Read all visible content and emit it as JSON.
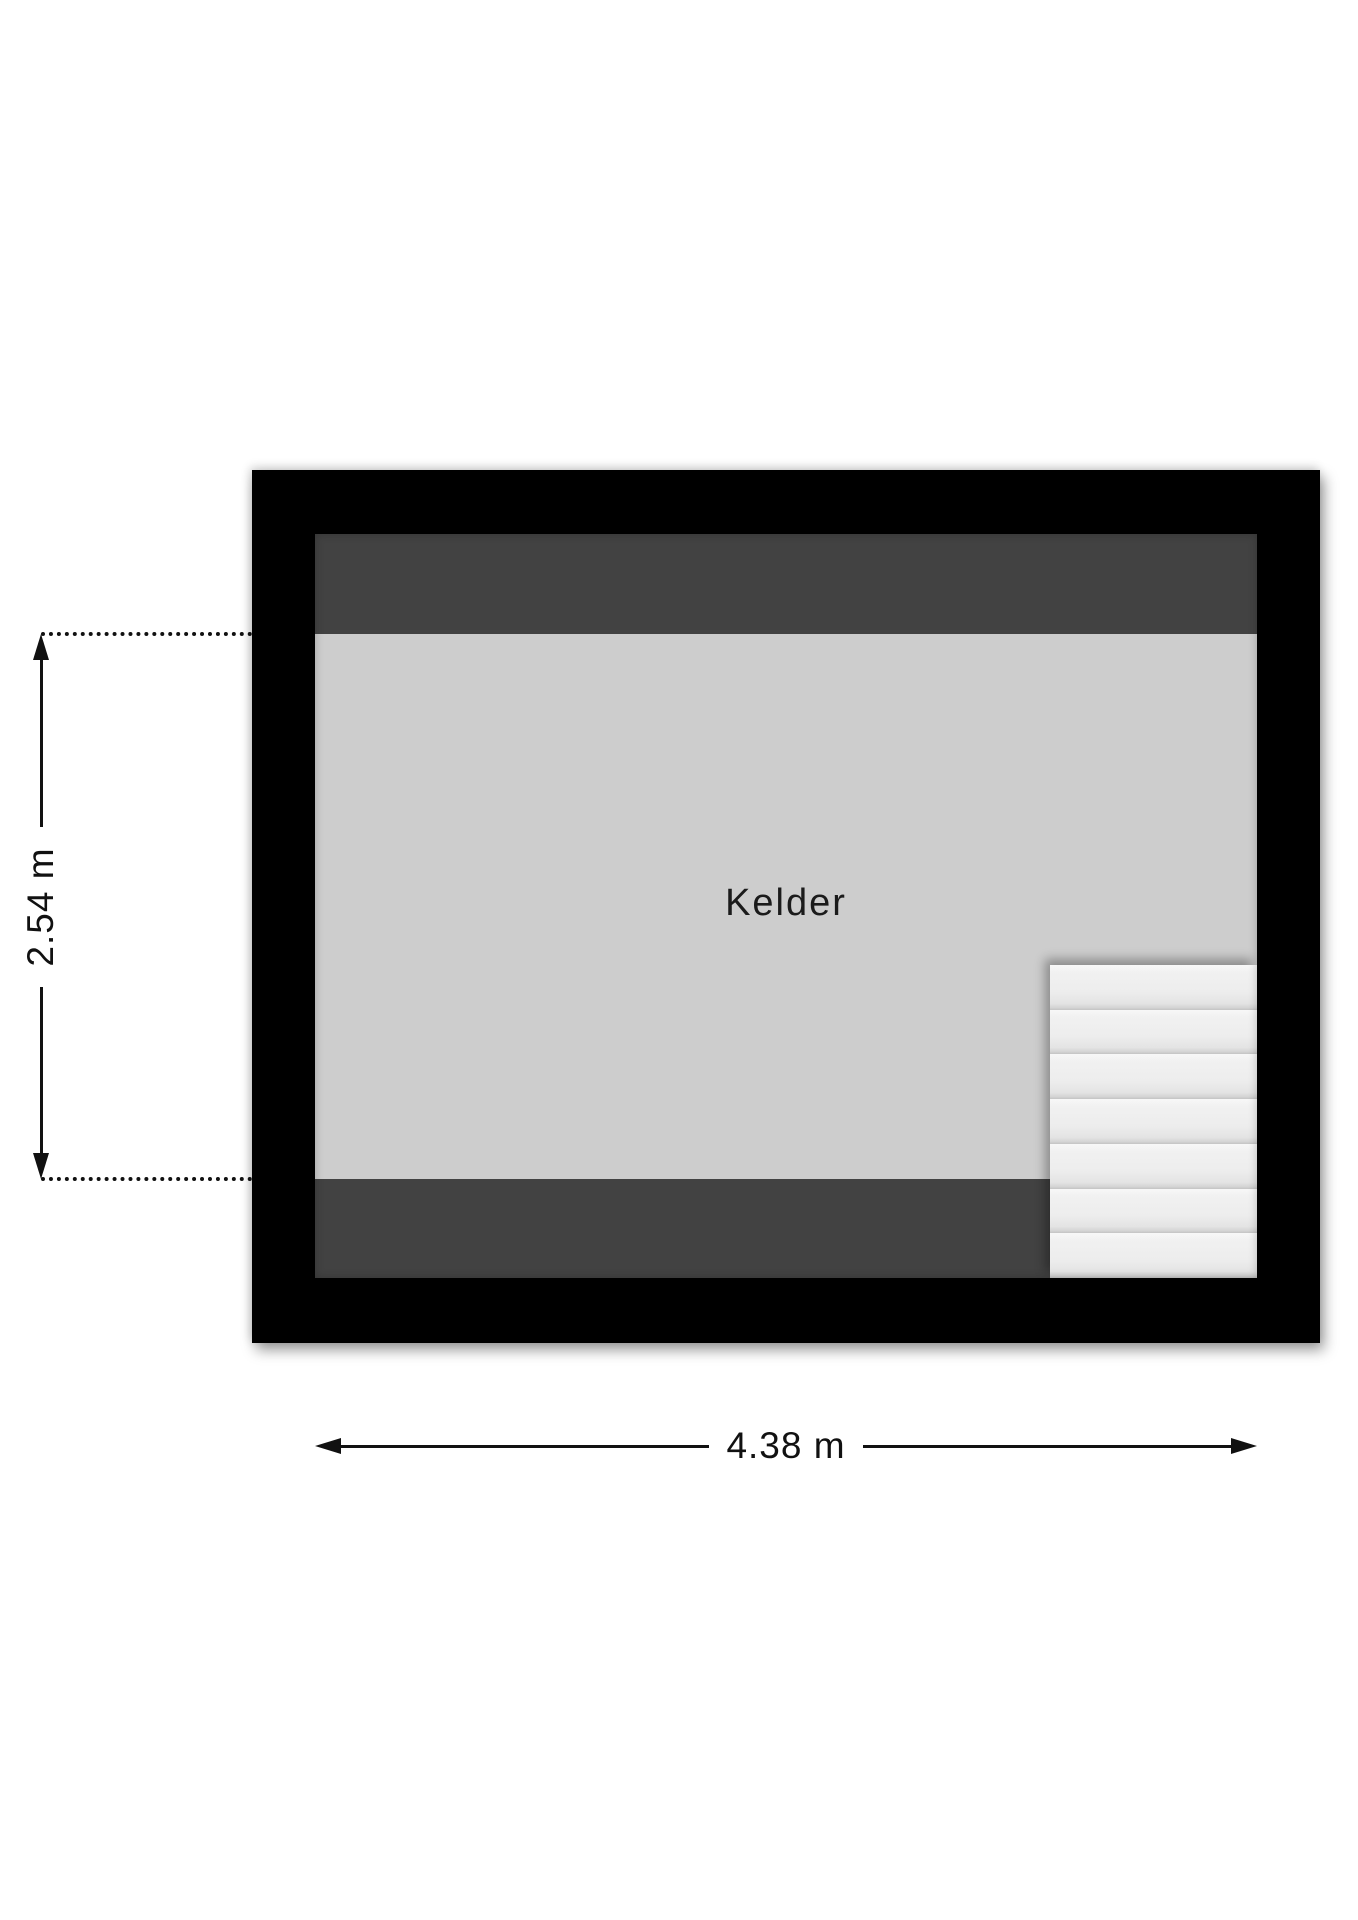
{
  "floorplan": {
    "room": {
      "label": "Kelder"
    },
    "dimensions": {
      "height_label": "2.54 m",
      "width_label": "4.38 m"
    },
    "stairs": {
      "tread_count": 7
    }
  },
  "colors": {
    "wall": "#000000",
    "band": "#424242",
    "floor": "#cdcdcd",
    "ink": "#111111",
    "bg": "#ffffff"
  }
}
